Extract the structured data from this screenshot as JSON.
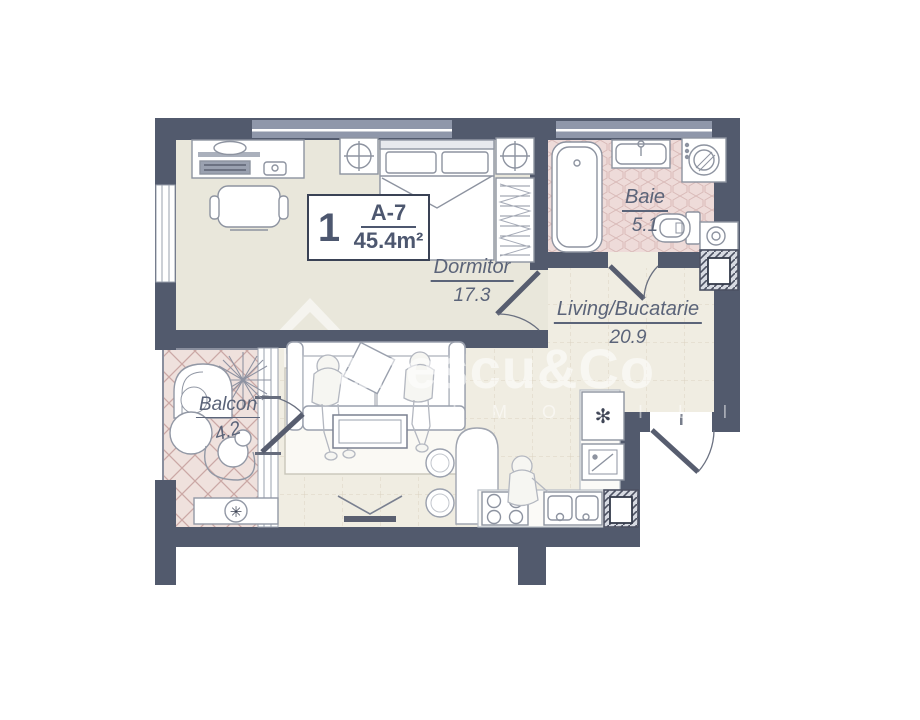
{
  "unit": {
    "number": "1",
    "code": "A-7",
    "area": "45.4m²"
  },
  "rooms": [
    {
      "id": "dormitor",
      "name": "Dormitor",
      "area": "17.3"
    },
    {
      "id": "baie",
      "name": "Baie",
      "area": "5.1"
    },
    {
      "id": "living",
      "name": "Living/Bucatarie",
      "area": "20.9"
    },
    {
      "id": "balcon",
      "name": "Balcon",
      "area": "4.2"
    }
  ],
  "watermark": {
    "brand": "anescu&Co",
    "tagline": "I M O B I L I A"
  },
  "icons": {
    "snowflake_glyph": "✻",
    "fan_glyph": "✳"
  },
  "colors": {
    "wall": "#525a6d",
    "wall_light": "#8f97aa",
    "label_text": "#5b6479",
    "bedroom_floor": "#e9e7db",
    "living_floor": "#f0ede2",
    "bath_tile": "#eedbd9",
    "balcony_tile": "#efe1dd"
  }
}
